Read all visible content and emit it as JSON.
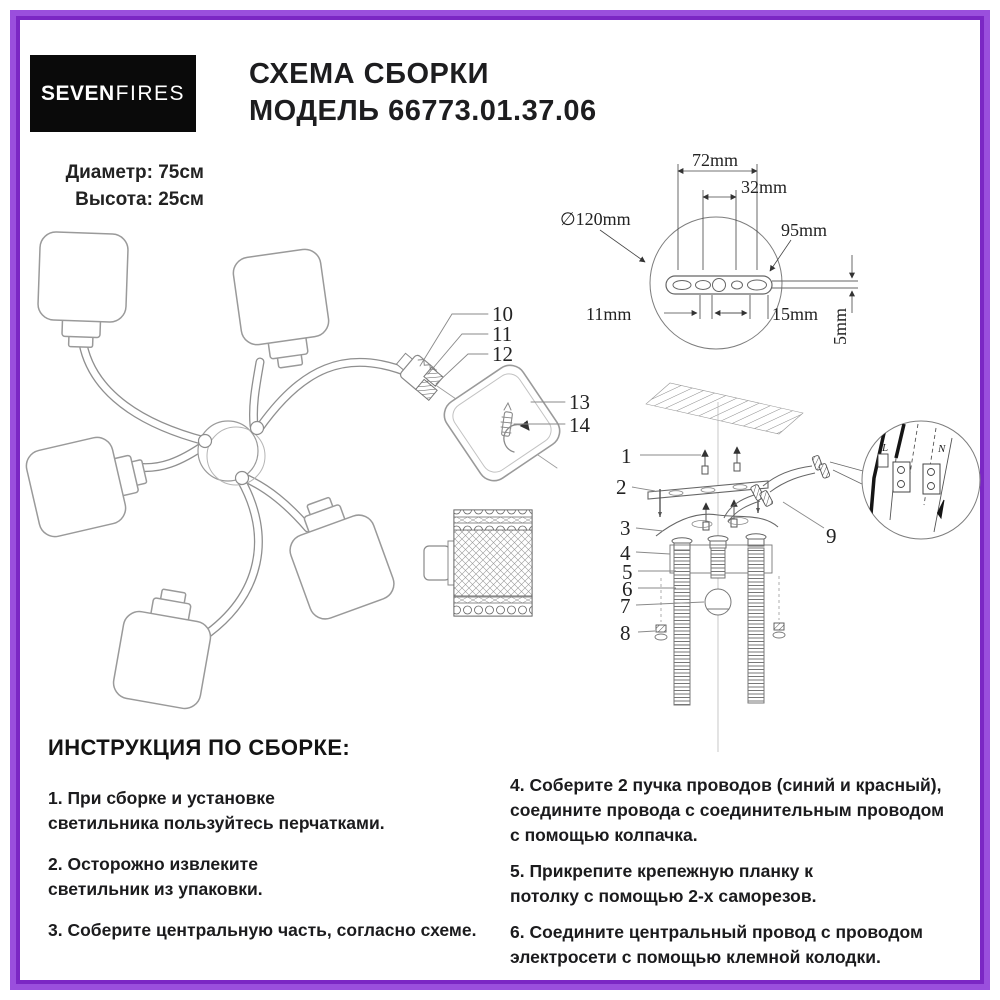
{
  "header": {
    "logo_bold": "SEVEN",
    "logo_light": "FIRES",
    "title_line1": "СХЕМА СБОРКИ",
    "title_line2": "МОДЕЛЬ 66773.01.37.06",
    "spec_diameter": "Диаметр: 75см",
    "spec_height": "Высота: 25см"
  },
  "bracket_detail": {
    "dim_72": "72mm",
    "dim_32": "32mm",
    "dim_diameter": "∅120mm",
    "dim_95": "95mm",
    "dim_11": "11mm",
    "dim_15": "15mm",
    "dim_5": "5mm"
  },
  "part_callouts": {
    "n1": "1",
    "n2": "2",
    "n3": "3",
    "n4": "4",
    "n5": "5",
    "n6": "6",
    "n7": "7",
    "n8": "8",
    "n9": "9",
    "n10": "10",
    "n11": "11",
    "n12": "12",
    "n13": "13",
    "n14": "14"
  },
  "terminal_detail": {
    "line_l": "L",
    "line_n": "N"
  },
  "instructions": {
    "heading": "ИНСТРУКЦИЯ ПО СБОРКЕ:",
    "col_left": [
      "1. При сборке и установке\nсветильника пользуйтесь перчатками.",
      "2. Осторожно извлеките\nсветильник из упаковки.",
      "3. Соберите центральную часть, согласно схеме."
    ],
    "col_right": [
      "4. Соберите 2 пучка проводов (синий и красный),\nсоедините провода с соединительным проводом\nс помощью колпачка.",
      "5. Прикрепите крепежную планку к\nпотолку с помощью 2-х саморезов.",
      "6. Соедините центральный провод с проводом\nэлектросети с помощью клемной колодки."
    ]
  },
  "colors": {
    "frame": "#8b3dcc",
    "logo_bg": "#0a0a0a"
  }
}
